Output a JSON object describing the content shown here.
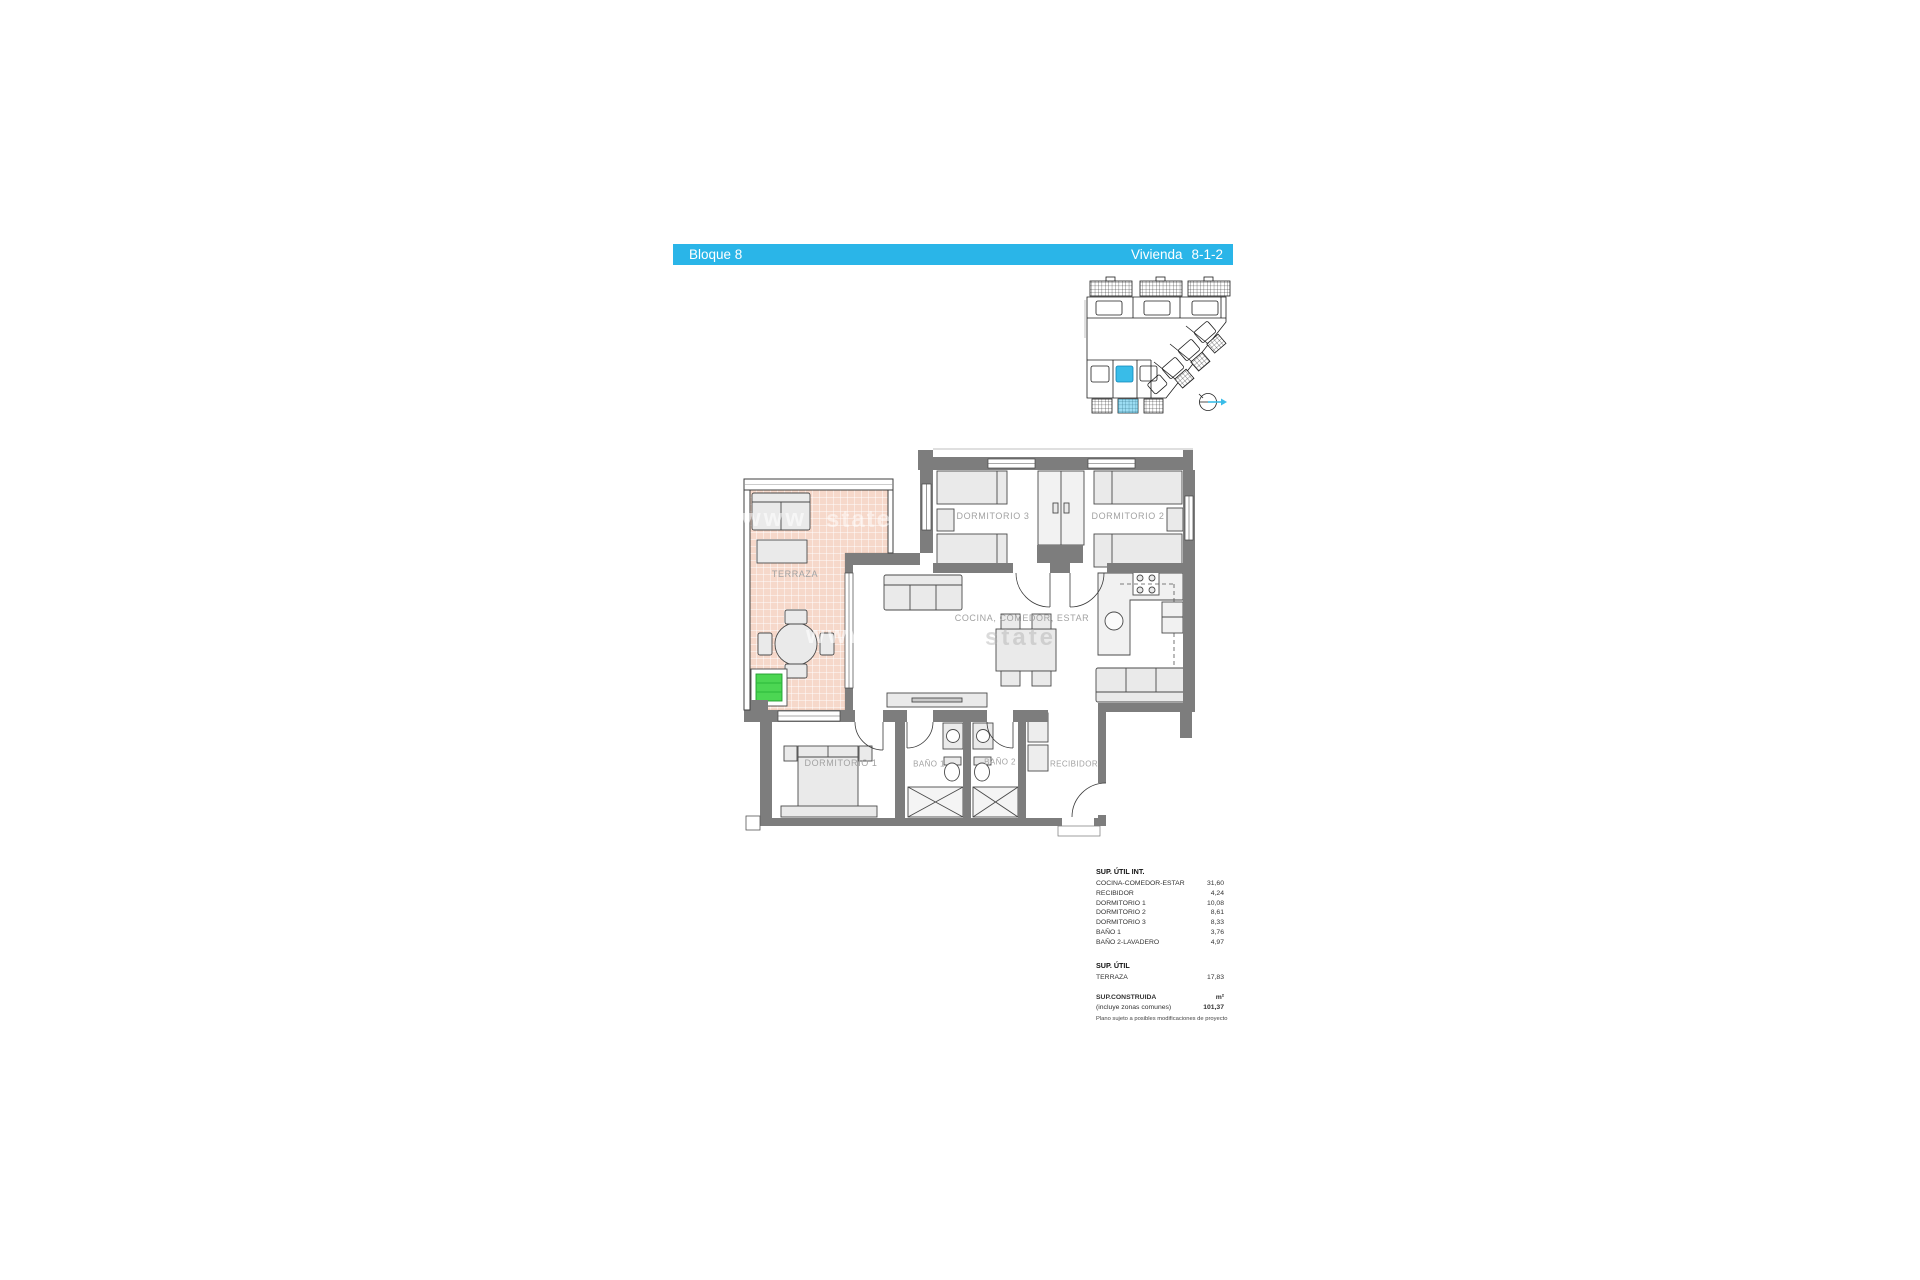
{
  "header": {
    "block": "Bloque 8",
    "dwelling": "Vivienda",
    "dwelling_number": "8-1-2",
    "bar_color": "#2ab5e8"
  },
  "site_plan": {
    "highlight_color": "#39bce8"
  },
  "floor_plan": {
    "rooms": {
      "terraza": "TERRAZA",
      "dormitorio3": "DORMITORIO 3",
      "dormitorio2": "DORMITORIO 2",
      "cocina": "COCINA, COMEDOR, ESTAR",
      "dormitorio1": "DORMITORIO 1",
      "bano1": "BAÑO 1",
      "bano2": "BAÑO 2",
      "recibidor": "RECIBIDOR"
    },
    "terrace_tile_color": "#f6d8ca",
    "wall_color": "#7d7d7d",
    "plant_color": "#4cd653"
  },
  "watermark": {
    "fragments": {
      "f1": "www",
      "f2": "state"
    }
  },
  "areas": {
    "util_int_title": "SUP. ÚTIL INT.",
    "util_int_rows": [
      {
        "label": "COCINA-COMEDOR-ESTAR",
        "value": "31,60"
      },
      {
        "label": "RECIBIDOR",
        "value": "4,24"
      },
      {
        "label": "DORMITORIO 1",
        "value": "10,08"
      },
      {
        "label": "DORMITORIO 2",
        "value": "8,61"
      },
      {
        "label": "DORMITORIO 3",
        "value": "8,33"
      },
      {
        "label": "BAÑO 1",
        "value": "3,76"
      },
      {
        "label": "BAÑO 2-LAVADERO",
        "value": "4,97"
      }
    ],
    "util_title": "SUP. ÚTIL",
    "util_rows": [
      {
        "label": "TERRAZA",
        "value": "17,83"
      }
    ],
    "built_title": "SUP.CONSTRUIDA",
    "built_unit": "m²",
    "built_note": "(incluye zonas comunes)",
    "built_value": "101,37",
    "footnote": "Plano sujeto a posibles modificaciones de proyecto"
  }
}
